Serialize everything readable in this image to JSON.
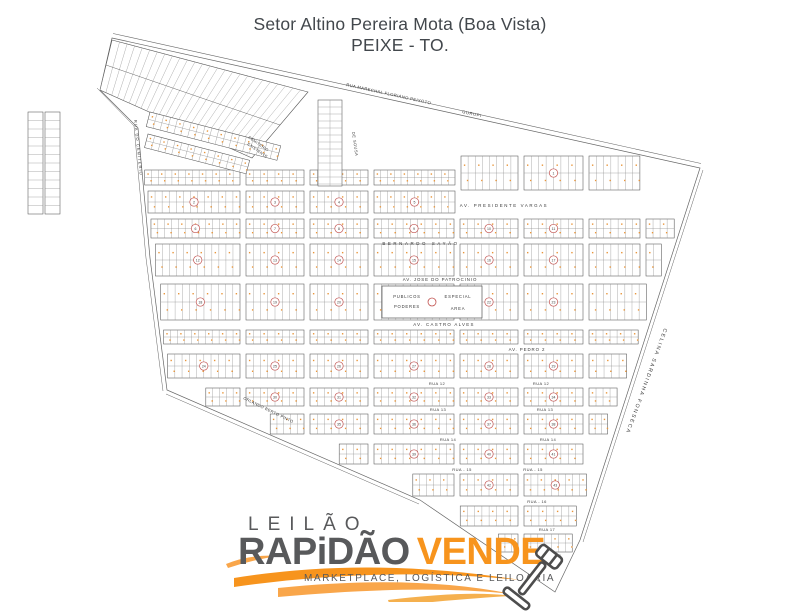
{
  "title": {
    "line1": "Setor Altino Pereira Mota (Boa Vista)",
    "line2": "PEIXE - TO."
  },
  "map": {
    "streets": [
      {
        "id": "marechal",
        "label": "RUA MARECHAL FLORIANO PEIXOTO"
      },
      {
        "id": "gurupi",
        "label": "GURUPI"
      },
      {
        "id": "cemiterio-road",
        "label": "RUA DO CEMITERIO"
      },
      {
        "id": "cemiterio-existente",
        "label": "CEMITERIO EXISTENTE"
      },
      {
        "id": "de-sousa",
        "label": "DE SOUSA"
      },
      {
        "id": "presidente-vargas",
        "label": "AV. PRESIDENTE VARGAS"
      },
      {
        "id": "bernardo-sayao",
        "label": "BERNARDO  SAYÃO"
      },
      {
        "id": "jose-patrocinio",
        "label": "AV. JOSE DO PATROCINIO"
      },
      {
        "id": "castro-alves",
        "label": "AV. CASTRO ALVES"
      },
      {
        "id": "pedro-ii",
        "label": "AV. PEDRO 2"
      },
      {
        "id": "rua-12",
        "label": "RUA 12"
      },
      {
        "id": "rua-13",
        "label": "RUA 13"
      },
      {
        "id": "rua-14",
        "label": "RUA 14"
      },
      {
        "id": "rua-15",
        "label": "RUA - 15"
      },
      {
        "id": "rua-16",
        "label": "RUA - 16"
      },
      {
        "id": "rua-17",
        "label": "RUA 17"
      },
      {
        "id": "rua-18",
        "label": "RUA 18"
      },
      {
        "id": "orlando",
        "label": "ORLANDO BERTO PINTO"
      },
      {
        "id": "celina",
        "label": "CELINA SARDINHA FONSECA"
      }
    ],
    "special_block": {
      "top_left": "PUBLICOS",
      "bottom_left": "PODERES",
      "top_right": "ESPECIAL",
      "bottom_right": "AREA"
    },
    "colors": {
      "map_line": "#666666",
      "lot_line": "#8a8a8a",
      "lot_dot": "#e8953a",
      "block_number_red": "#c0504d"
    }
  },
  "logo": {
    "word_top": "LEILÃO",
    "brand_main": "RAPiDÃO",
    "brand_accent": "VENDE",
    "tagline": "MARKETPLACE, LOGÍSTICA E LEILOARIA",
    "accent_orange": "#f7941d",
    "brand_gray": "#58595b"
  }
}
